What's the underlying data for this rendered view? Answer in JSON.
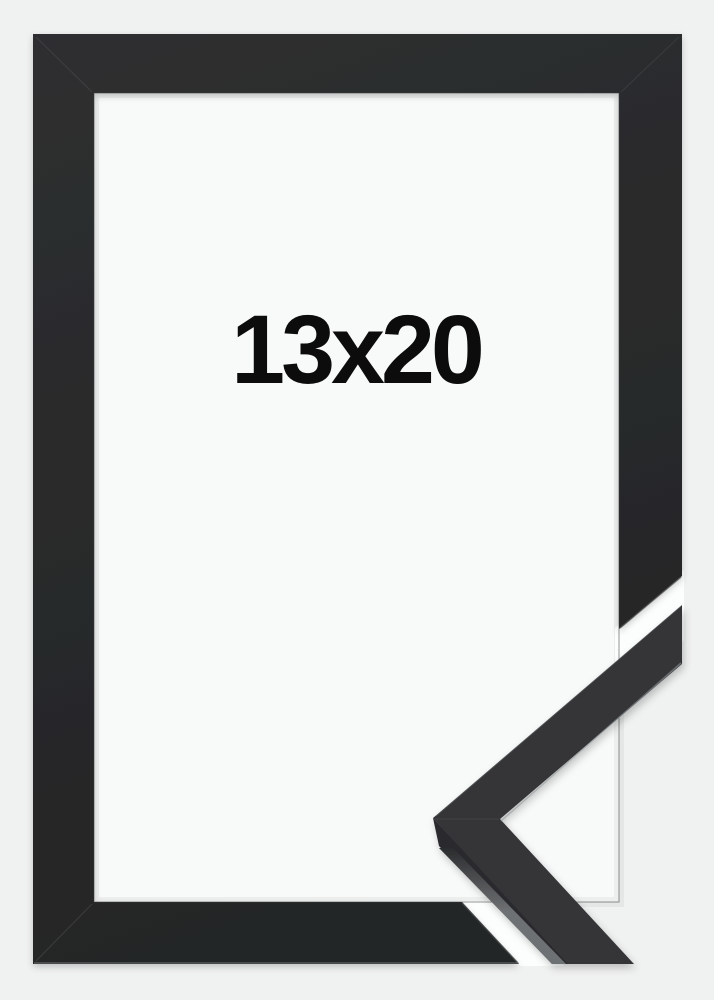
{
  "product": {
    "photo_alt": "black-picture-frame-product-photo",
    "label": {
      "text": "13x20"
    }
  },
  "colors": {
    "background": "#f0f1f1",
    "paper": "#f8f9f9",
    "cut_gap": "#fcfdfd",
    "frame_light": "#2e2f30",
    "frame_dark": "#242526",
    "sample_face": "#353639",
    "sample_side": "#2b2c2e",
    "sample_bevel": "#6e7173",
    "edge_highlight": "#8f9496",
    "seam": "#4a4b4d",
    "label_text": "#0c0c0c"
  }
}
